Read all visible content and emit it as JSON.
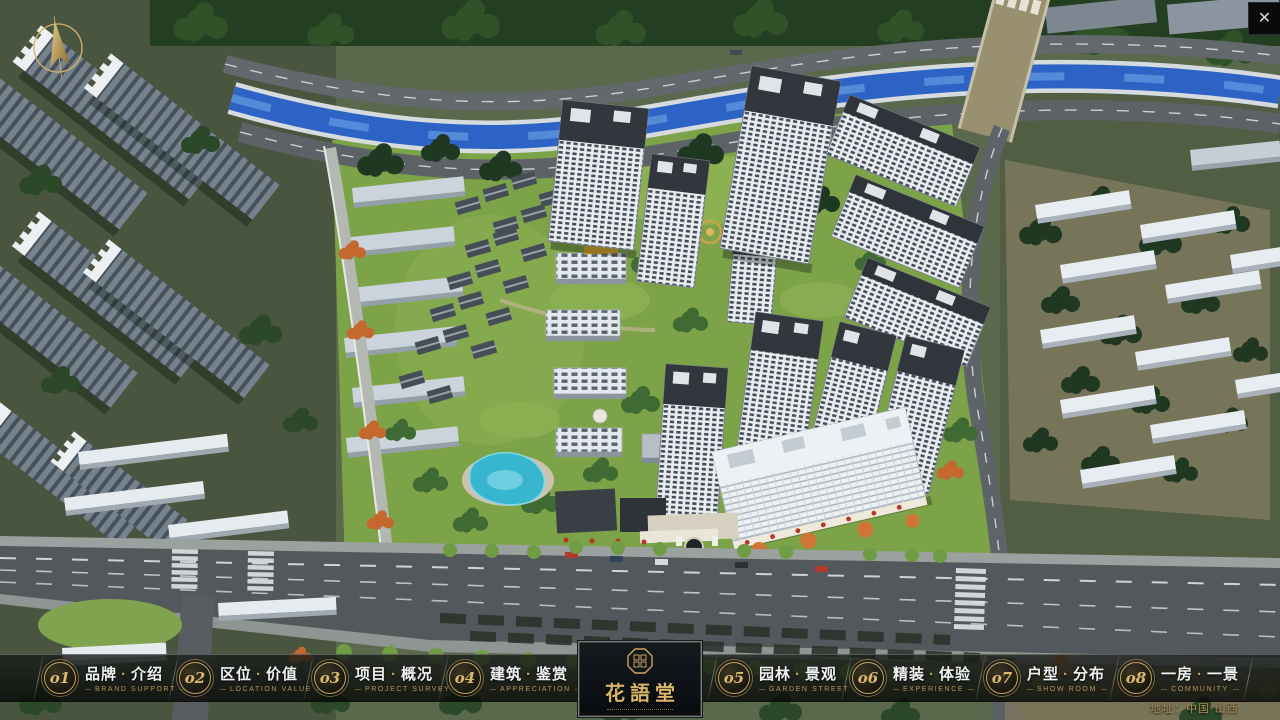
{
  "colors": {
    "gold": "#c9a55f",
    "gold-dim": "#b5945a",
    "bar-bg": "rgba(7,9,8,0.78)",
    "river": "#2e63c6",
    "grass": "#7da348"
  },
  "window": {
    "close": "✕"
  },
  "nav": {
    "sep": "·",
    "items": [
      {
        "num": "o1",
        "zh_a": "品牌",
        "zh_b": "介绍",
        "en": "BRAND SUPPORT"
      },
      {
        "num": "o2",
        "zh_a": "区位",
        "zh_b": "价值",
        "en": "LOCATION VALUE"
      },
      {
        "num": "o3",
        "zh_a": "项目",
        "zh_b": "概况",
        "en": "PROJECT SURVEY"
      },
      {
        "num": "o4",
        "zh_a": "建筑",
        "zh_b": "鉴赏",
        "en": "APPRECIATION"
      },
      {
        "num": "o5",
        "zh_a": "园林",
        "zh_b": "景观",
        "en": "GARDEN STREET"
      },
      {
        "num": "o6",
        "zh_a": "精装",
        "zh_b": "体验",
        "en": "EXPERIENCE"
      },
      {
        "num": "o7",
        "zh_a": "户型",
        "zh_b": "分布",
        "en": "SHOW ROOM"
      },
      {
        "num": "o8",
        "zh_a": "一房",
        "zh_b": "一景",
        "en": "COMMUNITY"
      }
    ]
  },
  "logo": {
    "title": "花語堂"
  },
  "footer": {
    "address": "地址：中国·山西"
  }
}
